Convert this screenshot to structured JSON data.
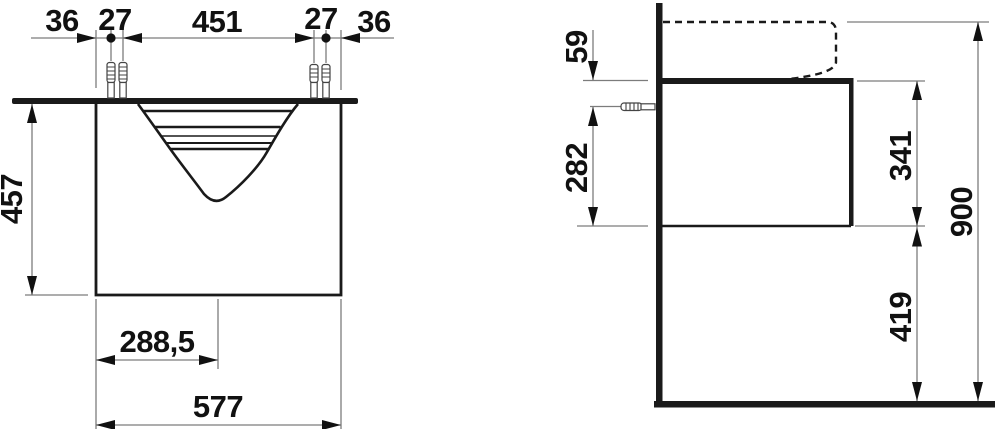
{
  "drawing": {
    "type": "technical-dimension-drawing",
    "subject": "washbasin with vanity unit, front and side elevation",
    "front_view": {
      "top_dims": [
        "36",
        "27",
        "451",
        "27",
        "36"
      ],
      "basin_depth": "457",
      "center_offset": "288,5",
      "total_width": "577"
    },
    "side_view": {
      "top_to_fixing": "59",
      "fixing_to_bottom": "282",
      "cabinet_height": "341",
      "floor_clearance": "419",
      "total_height": "900"
    },
    "colors": {
      "outline": "#1a1a1a",
      "dimension_lines": "#7c7c7c",
      "text": "#111111",
      "background": "#ffffff"
    }
  }
}
